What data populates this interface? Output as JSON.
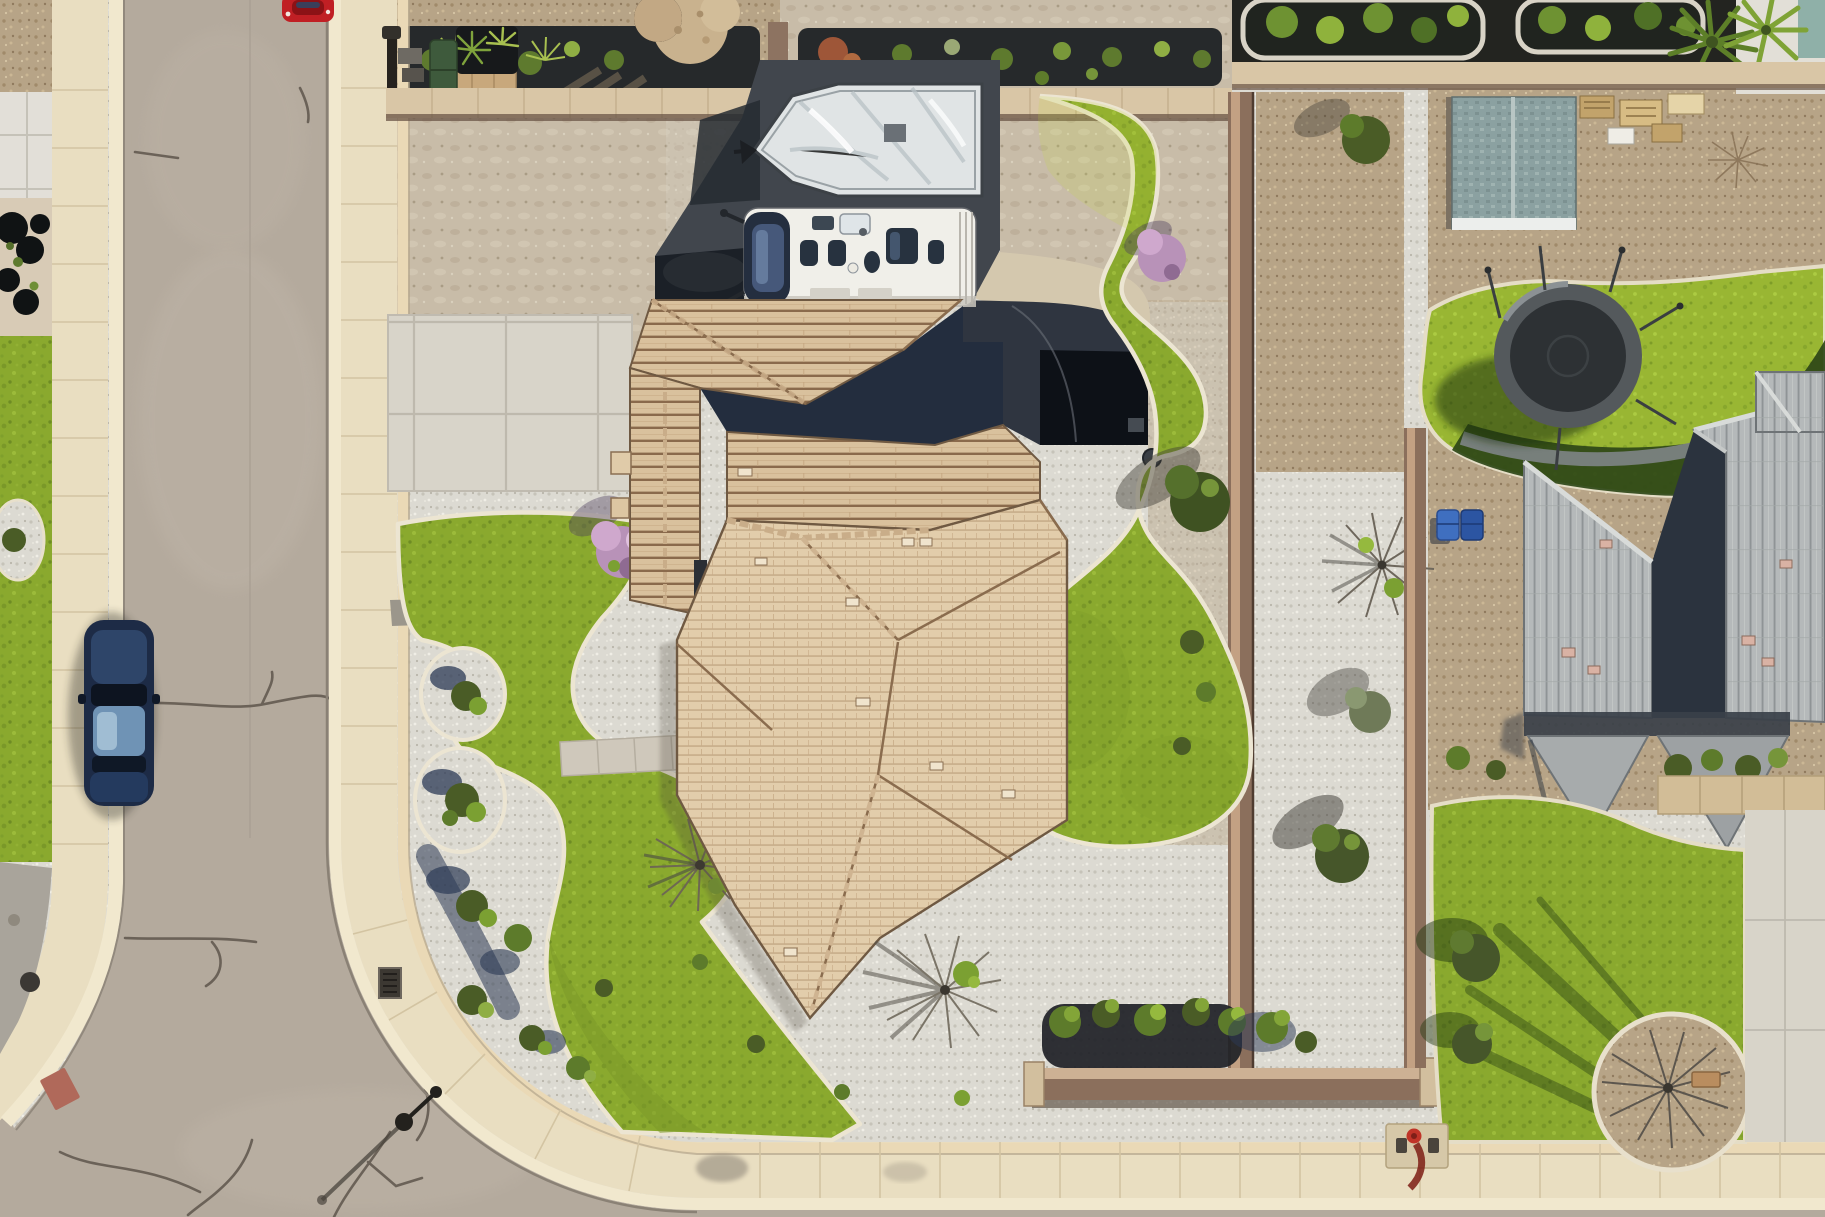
{
  "meta": {
    "kind": "aerial-drone-photo",
    "view": "top-down residential corner lot",
    "width_px": 1825,
    "height_px": 1217
  },
  "palette": {
    "asphalt": "#b4aa9d",
    "sidewalk": "#e9dec1",
    "curb_light": "#f1e8ce",
    "concrete": "#d8d4c9",
    "pad_dark": "#41464d",
    "pad_shadow": "#1b2027",
    "courtyard_dark": "#2f3540",
    "courtyard_black": "#0d1117",
    "wall_brown": "#8b6f5c",
    "wall_top": "#d9c6a6",
    "roof_shadow": "#232d3e",
    "roof_gray_shadow": "#2b333e",
    "boat_silver": "#e0e4e5",
    "rv_white": "#f0efe9",
    "glass_dark": "#242e3f",
    "car_blue": "#1d2b46",
    "car_red": "#c01f24",
    "bin_green": "#3e5a3c",
    "bin_blue": "#3f6fc0",
    "bin_blue_dark": "#2c55a2",
    "trampoline_mat": "#2d3134",
    "trampoline_ring": "#54595c",
    "shed_trim": "#eceeec",
    "soil_dark": "#26292b",
    "tree_olive": "#4a5c26",
    "tree_green": "#7ba032",
    "tree_purple": "#b892b8",
    "hydrant_red": "#c03428",
    "lawn_shadow": "#2e4617",
    "path_tan": "#d4c8ae",
    "walk_gray": "#9b968b",
    "paver_tan": "#c8a87c"
  },
  "scene": {
    "streets": [
      {
        "name": "west-street",
        "orientation": "vertical, curving at a corner intersection bottom-left",
        "features": [
          "pavement cracks",
          "cream curbs",
          "storm drain",
          "street lamp on corner sidewalk"
        ]
      },
      {
        "name": "south-street",
        "orientation": "horizontal along bottom edge"
      }
    ],
    "vehicles": [
      {
        "name": "red-car",
        "desc": "red car at top edge of street, partially cropped"
      },
      {
        "name": "blue-sedan",
        "desc": "dark blue sedan parked along left curb mid-image"
      },
      {
        "name": "rv-motorhome",
        "desc": "white class-A RV parked on dark asphalt pad beside house"
      },
      {
        "name": "boat",
        "desc": "boat with shiny silver cover, bow pointing left, on same pad"
      }
    ],
    "main_property": {
      "house": "large complex hip roof with tan/beige tiles, dark shaded north planes, attic vents",
      "backyard": "kidney-shaped bright lawn with concrete curbing, white gravel, shaded entry courtyard",
      "frontyard": "S-curved lawn, two round shrub beds, white-gravel bed with bushes, gray paver walkways",
      "walls": [
        "north block wall",
        "east block wall",
        "southeast front wall with pillar"
      ],
      "plants": [
        "purple flowering tree",
        "bare ornamental trees",
        "olive-green shrub rows",
        "desert shrubs"
      ]
    },
    "neighbor_right": {
      "house": "gray concrete-tile roof, two large gables plus front gables, pink lead vents",
      "backyard": [
        "garden shed with gray-green roof and white trim",
        "dark round trampoline with net poles",
        "lumber pallets",
        "raised planter beds",
        "two fan palms",
        "bright lawn with building shadow"
      ],
      "frontyard": [
        "lawn with long tree shadows",
        "circular gravel tree bed with bench",
        "concrete driveway",
        "blue trash bins",
        "red fire hydrant on pad"
      ]
    },
    "left_strip": [
      "white paver pad",
      "dark shrub bed",
      "narrow lawn",
      "gravel corner bed"
    ],
    "counts": {
      "palm_trees": 2,
      "round_shrub_beds": 2,
      "trash_bins": 3,
      "trampolines": 1,
      "sheds": 1
    }
  }
}
